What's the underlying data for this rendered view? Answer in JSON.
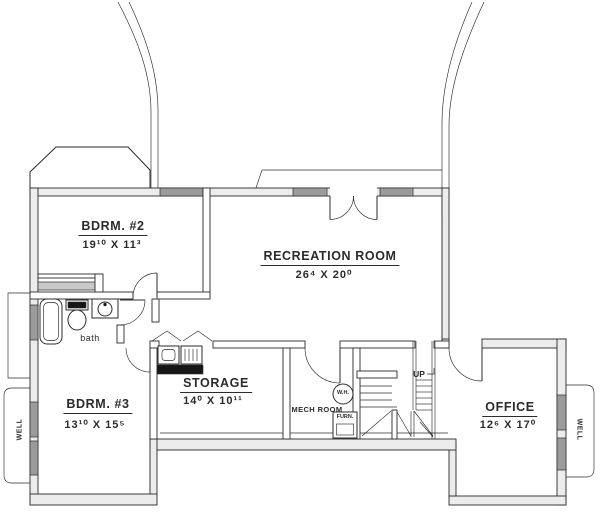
{
  "plan": {
    "title": "Basement floor plan",
    "rooms": {
      "bdrm2": {
        "name": "BDRM. #2",
        "dims": "19¹⁰ X 11³"
      },
      "recreation": {
        "name": "RECREATION ROOM",
        "dims": "26⁴ X 20⁰"
      },
      "bdrm3": {
        "name": "BDRM. #3",
        "dims": "13¹⁰ X 15⁵"
      },
      "storage": {
        "name": "STORAGE",
        "dims": "14⁰ X 10¹¹"
      },
      "office": {
        "name": "OFFICE",
        "dims": "12⁶ X 17⁰"
      },
      "mech": {
        "name": "MECH ROOM"
      },
      "bath": {
        "name": "bath"
      }
    },
    "fixtures": {
      "water_heater": "W.H.",
      "furnace": "FURN."
    },
    "stairs": {
      "up_label": "UP"
    },
    "wells": {
      "left_label": "WELL",
      "right_label": "WELL"
    },
    "colors": {
      "line": "#2b2b2b",
      "wall_fill": "#ececec",
      "window_fill": "#9b9b9b",
      "appliance_dark": "#161616",
      "background": "#ffffff"
    }
  }
}
